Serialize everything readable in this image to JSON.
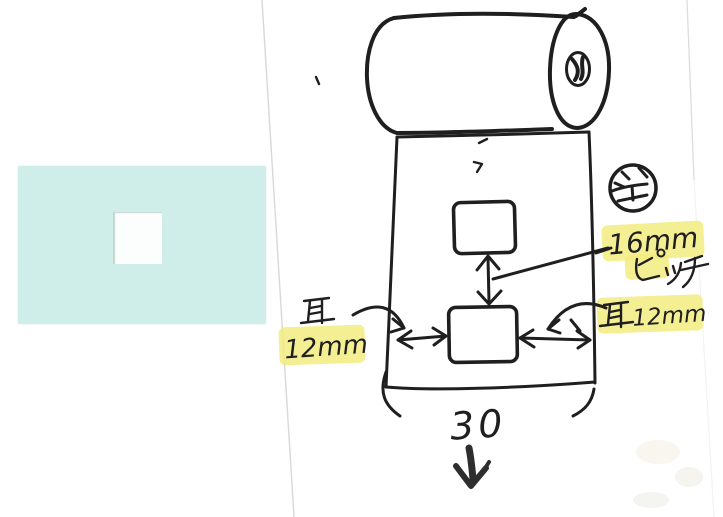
{
  "canvas": {
    "width": 723,
    "height": 517
  },
  "colors": {
    "paper": "#ffffff",
    "ink": "#1f1f1f",
    "marker": "#2e2e2e",
    "highlight": "#f3eb7d",
    "note_bg": "#cfede9",
    "hole_bg": "#fcfefd",
    "page_edge": "#d4d4cf"
  },
  "annotations": {
    "pitch": {
      "value": "16mm",
      "unit": "ピッチ"
    },
    "ear_left": {
      "kanji": "耳",
      "value": "12mm"
    },
    "ear_right": {
      "kanji": "耳",
      "value": "12mm"
    },
    "web_width": "30",
    "stamp": "全"
  }
}
